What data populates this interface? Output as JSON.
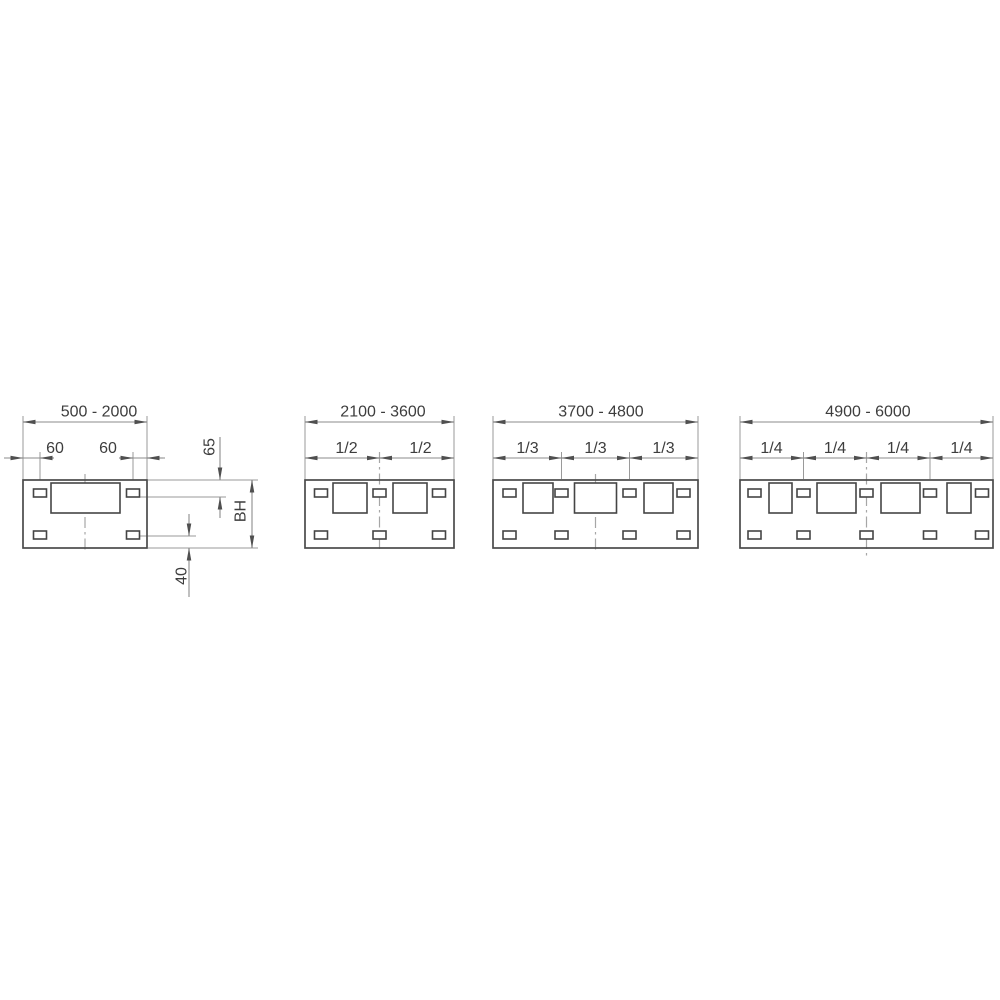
{
  "drawing": {
    "type": "technical-dimension-drawing",
    "background_color": "#ffffff",
    "outline_color": "#4a4a4a",
    "dimension_line_color": "#8b8b8b",
    "centerline_color": "#a6a6a6",
    "text_color": "#3d3d3d",
    "panels": [
      {
        "name": "panel-width-500-2000",
        "range_label": "500 - 2000",
        "section_labels": [],
        "dim_labels": {
          "left_slot_offset": "60",
          "right_slot_offset": "60",
          "top_slot_offset": "65",
          "body_height": "BH",
          "bottom_slot_offset": "40"
        }
      },
      {
        "name": "panel-width-2100-3600",
        "range_label": "2100 - 3600",
        "section_labels": [
          "1/2",
          "1/2"
        ]
      },
      {
        "name": "panel-width-3700-4800",
        "range_label": "3700 - 4800",
        "section_labels": [
          "1/3",
          "1/3",
          "1/3"
        ]
      },
      {
        "name": "panel-width-4900-6000",
        "range_label": "4900 - 6000",
        "section_labels": [
          "1/4",
          "1/4",
          "1/4",
          "1/4"
        ]
      }
    ]
  }
}
